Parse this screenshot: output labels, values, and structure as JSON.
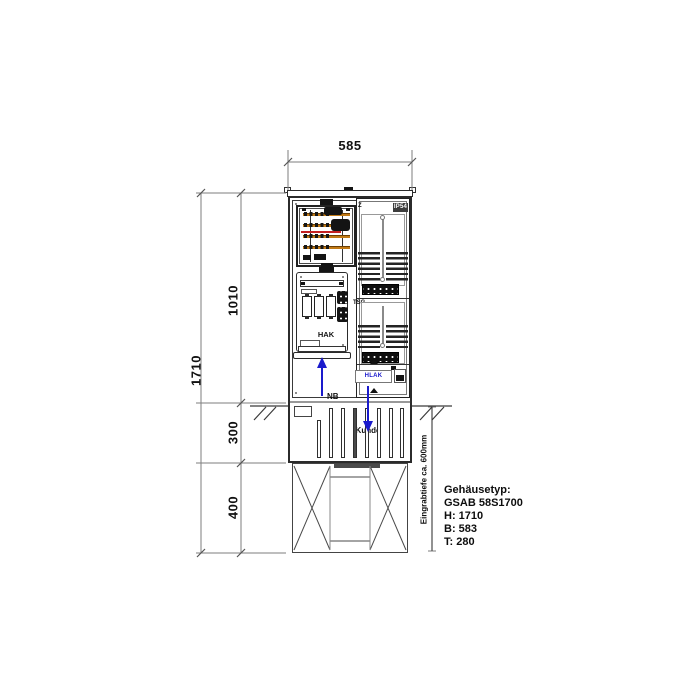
{
  "dimensions": {
    "width": "585",
    "total_height": "1710",
    "upper_height": "1010",
    "socket_height": "300",
    "foundation_height": "400"
  },
  "annotations": {
    "burial_depth": "Eingrabtiefe ca. 600mm",
    "meter_field": "Z",
    "protection_rating": "IP54",
    "control_field": "TSG",
    "service_box": "HAK",
    "customer_terminal": "HLAK",
    "grid_arrow": "NB",
    "customer_arrow": "Kunde"
  },
  "info_block": {
    "lines": [
      "Gehäusetyp:",
      "GSAB 58S1700",
      "H: 1710",
      "B: 583",
      "T: 280"
    ]
  },
  "colors": {
    "busbar": "#c27a16",
    "wire": "#c42020",
    "arrow": "#1a1acc",
    "badge_bg": "#3d3d3d",
    "badge_text": "#ffffff",
    "dimline": "#7d7d7d",
    "line": "#2b2b2b"
  }
}
